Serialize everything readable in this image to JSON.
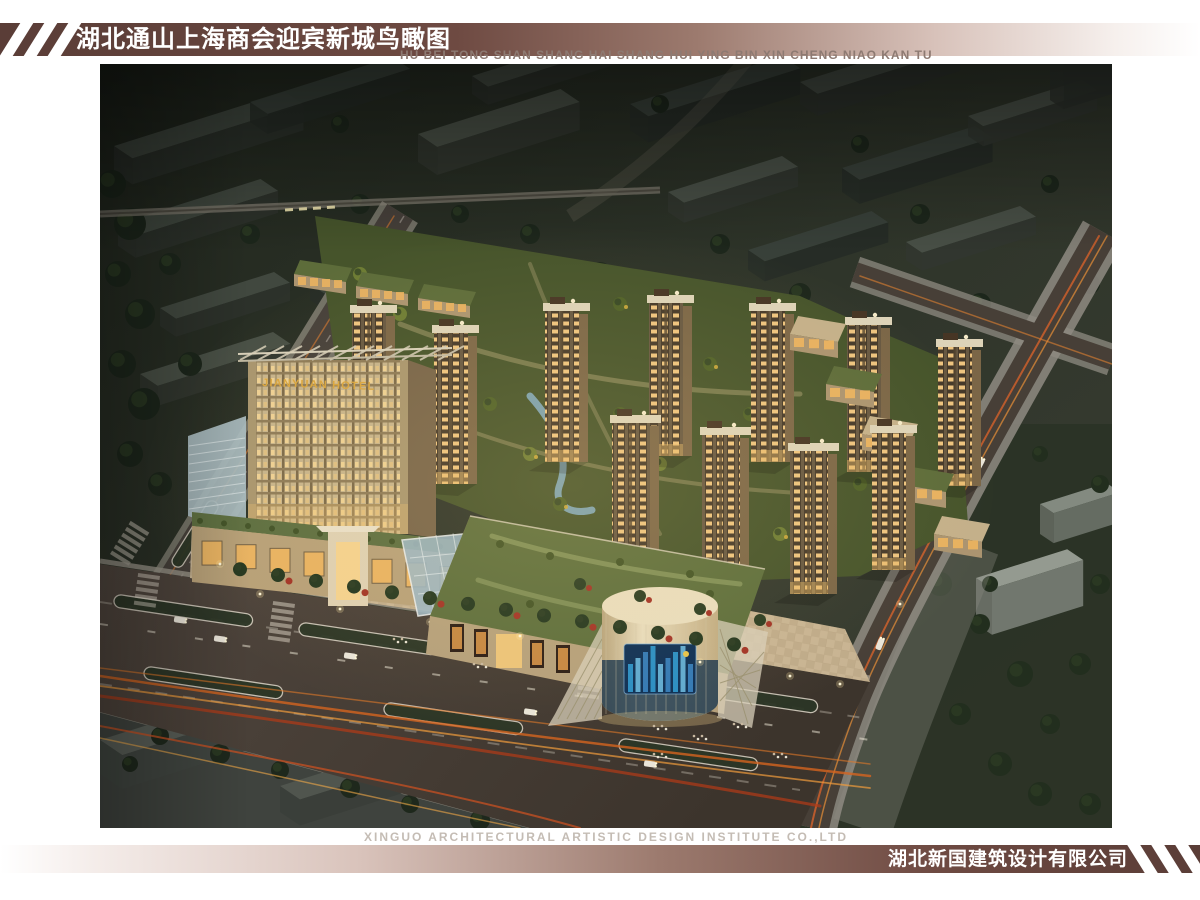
{
  "header": {
    "title_cn": "湖北通山上海商会迎宾新城鸟瞰图",
    "subtitle_pinyin": "HU BEI TONG SHAN SHANG HAI SHANG HUI YING BIN XIN CHENG NIAO KAN TU"
  },
  "footer": {
    "credit_en": "XINGUO ARCHITECTURAL ARTISTIC DESIGN INSTITUTE CO.,LTD",
    "company_cn": "湖北新国建筑设计有限公司"
  },
  "render": {
    "hotel_sign": "JIANYUAN HOTEL"
  },
  "theme": {
    "bar_dark": "#5a3d37",
    "bar_mid": "#9c7a6e",
    "bar_light": "#d8c2ba",
    "title_color": "#ffffff",
    "pinyin_color": "#8d7a72",
    "credit_color": "#c4bcb4",
    "gold_sign": "#d9a53e",
    "asphalt": "#4a423c",
    "light_trail_orange": "#e07828",
    "lawn_green": "#46542b",
    "facade_beige": "#c3b28c"
  }
}
